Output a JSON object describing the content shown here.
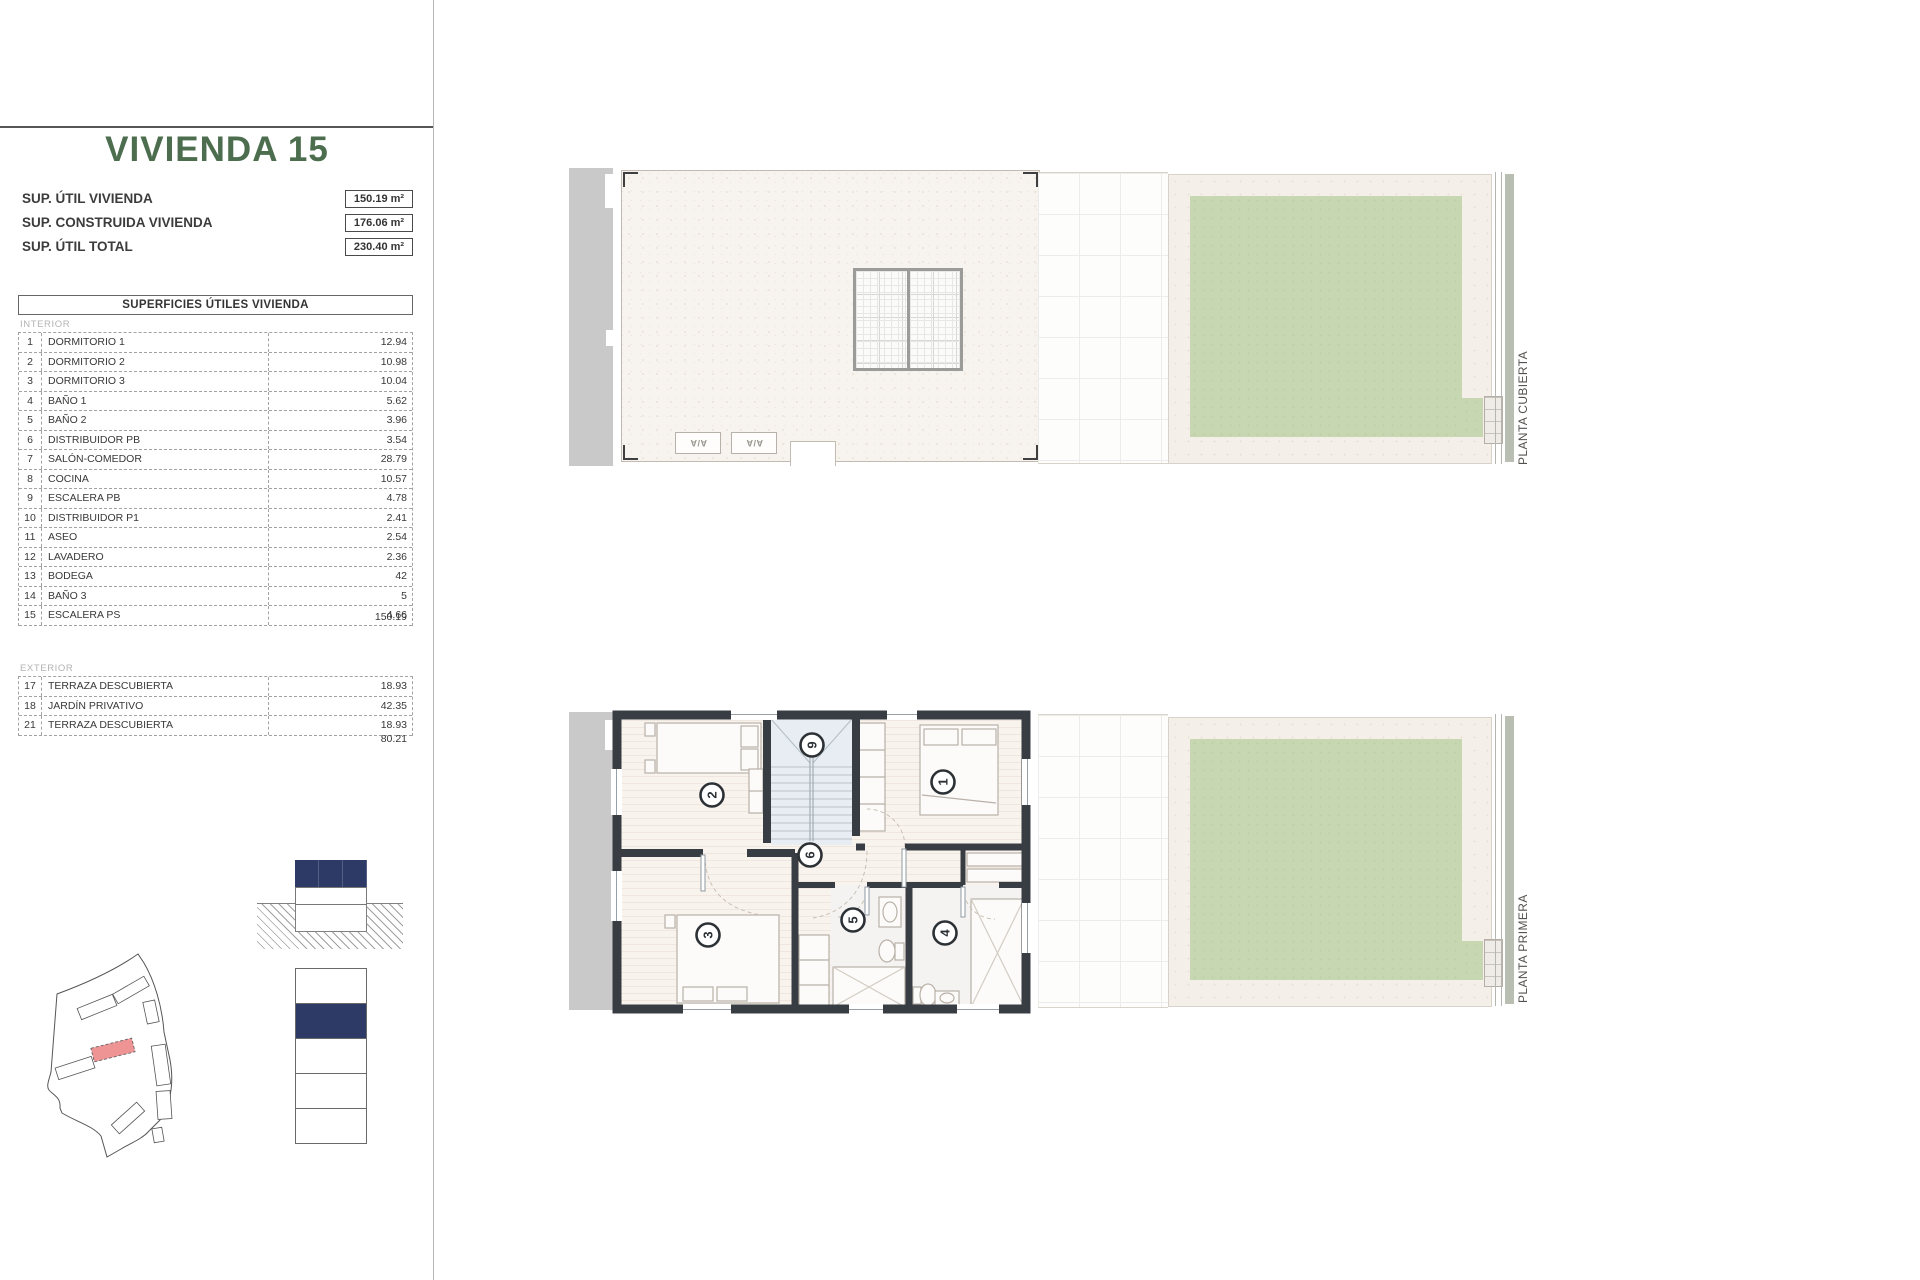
{
  "panel": {
    "title": "VIVIENDA 15",
    "summary": [
      {
        "label": "SUP. ÚTIL VIVIENDA",
        "value": "150.19 m²"
      },
      {
        "label": "SUP. CONSTRUIDA VIVIENDA",
        "value": "176.06 m²"
      },
      {
        "label": "SUP. ÚTIL TOTAL",
        "value": "230.40 m²"
      }
    ],
    "table_title": "SUPERFICIES ÚTILES VIVIENDA",
    "interior": {
      "label": "INTERIOR",
      "rows": [
        {
          "num": "1",
          "name": "DORMITORIO 1",
          "value": "12.94"
        },
        {
          "num": "2",
          "name": "DORMITORIO 2",
          "value": "10.98"
        },
        {
          "num": "3",
          "name": "DORMITORIO 3",
          "value": "10.04"
        },
        {
          "num": "4",
          "name": "BAÑO 1",
          "value": "5.62"
        },
        {
          "num": "5",
          "name": "BAÑO 2",
          "value": "3.96"
        },
        {
          "num": "6",
          "name": "DISTRIBUIDOR PB",
          "value": "3.54"
        },
        {
          "num": "7",
          "name": "SALÓN-COMEDOR",
          "value": "28.79"
        },
        {
          "num": "8",
          "name": "COCINA",
          "value": "10.57"
        },
        {
          "num": "9",
          "name": "ESCALERA PB",
          "value": "4.78"
        },
        {
          "num": "10",
          "name": "DISTRIBUIDOR P1",
          "value": "2.41"
        },
        {
          "num": "11",
          "name": "ASEO",
          "value": "2.54"
        },
        {
          "num": "12",
          "name": "LAVADERO",
          "value": "2.36"
        },
        {
          "num": "13",
          "name": "BODEGA",
          "value": "42"
        },
        {
          "num": "14",
          "name": "BAÑO 3",
          "value": "5"
        },
        {
          "num": "15",
          "name": "ESCALERA PS",
          "value": "4.66"
        }
      ],
      "total": "150.19"
    },
    "exterior": {
      "label": "EXTERIOR",
      "rows": [
        {
          "num": "17",
          "name": "TERRAZA DESCUBIERTA",
          "value": "18.93"
        },
        {
          "num": "18",
          "name": "JARDÍN PRIVATIVO",
          "value": "42.35"
        },
        {
          "num": "21",
          "name": "TERRAZA DESCUBIERTA",
          "value": "18.93"
        }
      ],
      "total": "80.21"
    }
  },
  "plans": {
    "top_label": "PLANTA CUBIERTA",
    "bottom_label": "PLANTA PRIMERA",
    "ac_label": "A/A",
    "rooms": {
      "r9": "9",
      "r2": "2",
      "r1": "1",
      "r6": "6",
      "r5": "5",
      "r3": "3",
      "r4": "4"
    }
  },
  "colors": {
    "accent_green": "#4c6e4e",
    "navy": "#2d3a66",
    "highlight_red": "#ee9495",
    "garden_green": "#c7d7b2",
    "wall_dark": "#383d43"
  }
}
